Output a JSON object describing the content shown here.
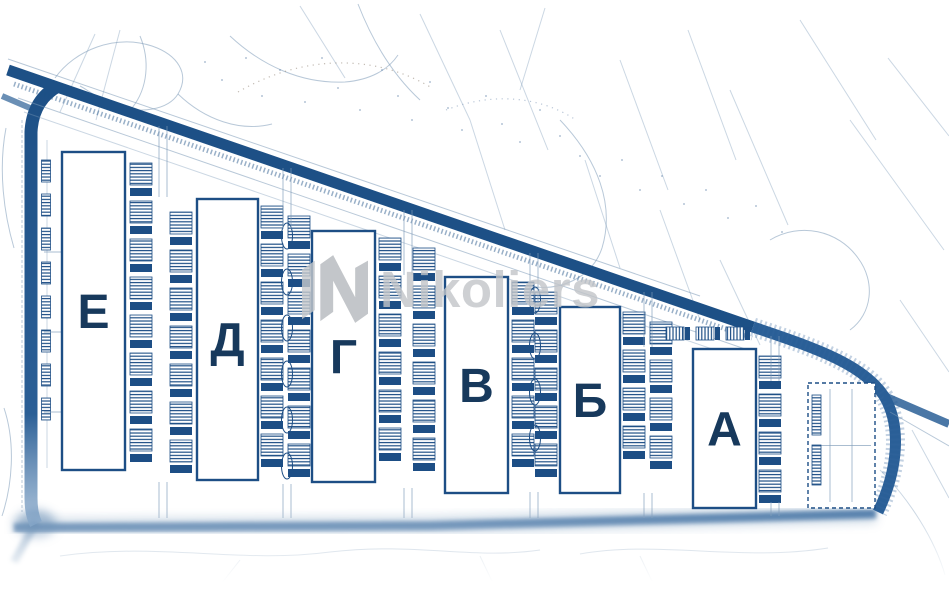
{
  "page": {
    "watermark": {
      "text": "Nikoliers",
      "icon": "nikoliers-logo-icon",
      "color": "#c2c5c9"
    },
    "colors": {
      "road": "#1d5086",
      "road_light": "#5b84b2",
      "outline": "#1d4e85",
      "label": "#17395c",
      "contour": "#7e9ab8"
    }
  },
  "site_plan": {
    "type": "warehouse-site-plan",
    "buildings": [
      {
        "key": "e",
        "label": "Е",
        "x": 62,
        "y": 152,
        "w": 63,
        "h": 318
      },
      {
        "key": "d",
        "label": "Д",
        "x": 197,
        "y": 199,
        "w": 61,
        "h": 281
      },
      {
        "key": "g",
        "label": "Г",
        "x": 312,
        "y": 231,
        "w": 63,
        "h": 251
      },
      {
        "key": "v",
        "label": "В",
        "x": 445,
        "y": 277,
        "w": 63,
        "h": 216
      },
      {
        "key": "b",
        "label": "Б",
        "x": 560,
        "y": 307,
        "w": 60,
        "h": 186
      },
      {
        "key": "a",
        "label": "А",
        "x": 693,
        "y": 349,
        "w": 63,
        "h": 159
      }
    ],
    "future_building": {
      "x": 808,
      "y": 383,
      "w": 67,
      "h": 125
    },
    "dock_columns": [
      {
        "x": 46,
        "y1": 160,
        "y2": 452,
        "narrow": true
      },
      {
        "x": 141,
        "y1": 163,
        "y2": 462
      },
      {
        "x": 181,
        "y1": 212,
        "y2": 472
      },
      {
        "x": 272,
        "y1": 206,
        "y2": 474
      },
      {
        "x": 299,
        "y1": 216,
        "y2": 476
      },
      {
        "x": 390,
        "y1": 238,
        "y2": 478
      },
      {
        "x": 424,
        "y1": 248,
        "y2": 482
      },
      {
        "x": 523,
        "y1": 282,
        "y2": 486
      },
      {
        "x": 546,
        "y1": 292,
        "y2": 487
      },
      {
        "x": 634,
        "y1": 312,
        "y2": 489
      },
      {
        "x": 661,
        "y1": 322,
        "y2": 489
      },
      {
        "x": 770,
        "y1": 356,
        "y2": 500
      }
    ],
    "dock_rows": [
      {
        "y": 327,
        "x1": 666,
        "x2": 758
      }
    ],
    "island_lanes": [
      {
        "x": 287,
        "y1": 236,
        "y2": 468,
        "pitch": 46
      },
      {
        "x": 535,
        "y1": 300,
        "y2": 480,
        "pitch": 46
      }
    ],
    "lanes": [
      [
        163,
        126,
        197
      ],
      [
        287,
        168,
        229
      ],
      [
        408,
        210,
        275
      ],
      [
        534,
        253,
        305
      ],
      [
        648,
        292,
        347
      ],
      [
        775,
        336,
        381
      ],
      [
        163,
        482,
        518
      ],
      [
        287,
        484,
        518
      ],
      [
        408,
        488,
        518
      ],
      [
        534,
        492,
        518
      ],
      [
        648,
        493,
        518
      ],
      [
        775,
        502,
        516
      ]
    ]
  }
}
